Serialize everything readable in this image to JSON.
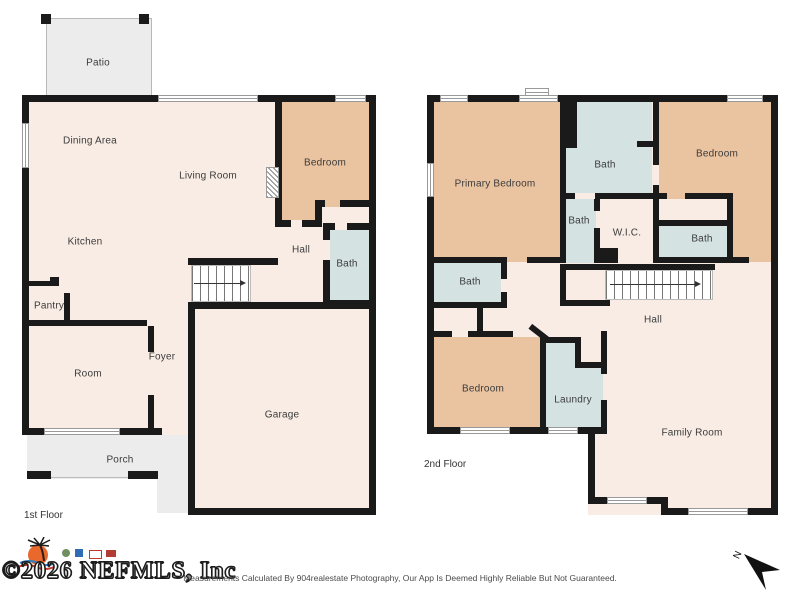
{
  "floors": {
    "first": {
      "label": "1st Floor",
      "rooms": {
        "patio": "Patio",
        "dining_area": "Dining Area",
        "living_room": "Living Room",
        "kitchen": "Kitchen",
        "bedroom": "Bedroom",
        "hall": "Hall",
        "bath": "Bath",
        "pantry": "Pantry",
        "room": "Room",
        "foyer": "Foyer",
        "garage": "Garage",
        "porch": "Porch"
      }
    },
    "second": {
      "label": "2nd Floor",
      "rooms": {
        "primary_bedroom": "Primary Bedroom",
        "bath_top": "Bath",
        "bedroom_right": "Bedroom",
        "bath_middle": "Bath",
        "wic": "W.I.C.",
        "bath_right": "Bath",
        "bath_left": "Bath",
        "hall": "Hall",
        "bedroom_lower": "Bedroom",
        "laundry": "Laundry",
        "family_room": "Family Room"
      }
    }
  },
  "footer": {
    "watermark": "©2026 NEFMLS, Inc",
    "disclaimer": "Measurements Calculated By 904realestate Photography, Our App Is Deemed Highly Reliable But Not Guaranteed.",
    "north_label": "N"
  },
  "colors": {
    "wall": "#1a1a1a",
    "floor_cream": "#f8ece5",
    "bedroom_tan": "#eac3a0",
    "bath_blue": "#d5e2e2",
    "outdoor_gray": "#ececec"
  }
}
